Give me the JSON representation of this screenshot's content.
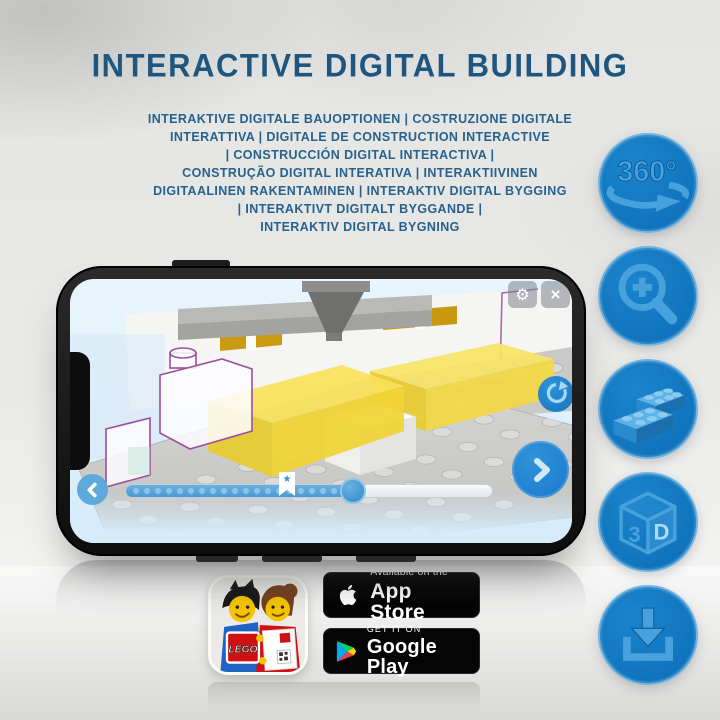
{
  "page": {
    "title": "INTERACTIVE DIGITAL BUILDING",
    "subtitle_lines": [
      "INTERAKTIVE DIGITALE BAUOPTIONEN | COSTRUZIONE DIGITALE",
      "INTERATTIVA | DIGITALE DE CONSTRUCTION INTERACTIVE",
      "| CONSTRUCCIÓN DIGITAL INTERACTIVA |",
      "CONSTRUÇÃO DIGITAL INTERATIVA | INTERAKTIIVINEN",
      "DIGITAALINEN RAKENTAMINEN | INTERAKTIV DIGITAL BYGGING",
      "| INTERAKTIVT DIGITALT BYGGANDE |",
      "INTERAKTIV DIGITAL BYGNING"
    ]
  },
  "features": {
    "items": [
      {
        "name": "360-rotation-icon",
        "label": "360°"
      },
      {
        "name": "zoom-in-icon",
        "label": ""
      },
      {
        "name": "lego-brick-icon",
        "label": ""
      },
      {
        "name": "3d-view-icon",
        "face_left": "3",
        "face_right": "D"
      },
      {
        "name": "download-icon",
        "label": ""
      }
    ]
  },
  "phone": {
    "screen_controls": {
      "settings_glyph": "⚙",
      "close_glyph": "×",
      "star_marker_glyph": "★"
    },
    "slider": {
      "dot_count": 20,
      "filled_ratio": 0.62,
      "marker_ratio": 0.44
    }
  },
  "badges": {
    "app_store": {
      "top": "Available on the",
      "bottom": "App Store"
    },
    "google_play": {
      "top": "GET IT ON",
      "bottom": "Google Play"
    },
    "lego_logo": "LEGO"
  },
  "colors": {
    "title_text": "#1e5680",
    "subtitle_text": "#27628f",
    "circle_fill": "#0f74bd",
    "circle_rim": "#6fb3e0",
    "circle_icon": "#47a2dc",
    "circle_icon_dark": "#0d5c9a",
    "sky_top": "#e9f5fc",
    "sky_bottom": "#d5ecfa",
    "slab_yellow": "#f2d435",
    "outline_purple": "#9b4f9e",
    "plate_gray": "#cbcbc9",
    "slider_fill": "#4a9bd4",
    "dot_blue": "#8ec4e8",
    "control_blue": "#1b7cc6",
    "next_blue": "#1f7fd0",
    "back_blue": "#5ea9dc",
    "badge_bg": "#050505",
    "lego_red": "#d01012"
  }
}
